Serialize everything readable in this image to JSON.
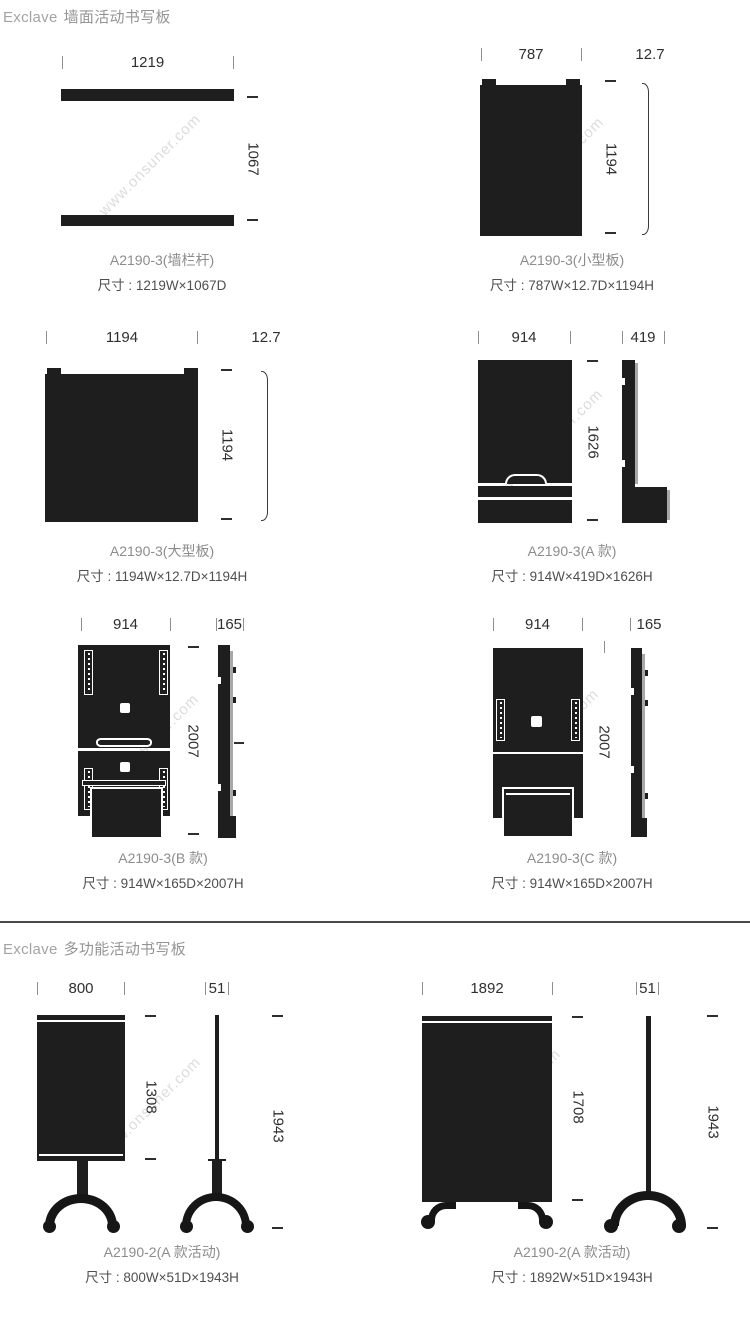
{
  "watermark": "www.onsuner.com",
  "colors": {
    "ink": "#1e1e1e",
    "dimension_text": "#2f2f2f",
    "caption_name": "#8c8c8c",
    "caption_size": "#4f4f4f",
    "header_text": "#949494",
    "divider": "#4a4a4a",
    "watermark": "#dcdcdc"
  },
  "sections": [
    {
      "brand": "Exclave",
      "title": "墙面活动书写板",
      "panels": [
        {
          "width": "1219",
          "height": "1067",
          "name": "A2190-3(墙栏杆)",
          "size": "尺寸 : 1219W×1067D"
        },
        {
          "width": "787",
          "depth": "12.7",
          "height": "1194",
          "name": "A2190-3(小型板)",
          "size": "尺寸 : 787W×12.7D×1194H"
        },
        {
          "width": "1194",
          "depth": "12.7",
          "height": "1194",
          "name": "A2190-3(大型板)",
          "size": "尺寸 : 1194W×12.7D×1194H"
        },
        {
          "width": "914",
          "depth": "419",
          "height": "1626",
          "name": "A2190-3(A 款)",
          "size": "尺寸 : 914W×419D×1626H"
        },
        {
          "width": "914",
          "depth": "165",
          "height": "2007",
          "name": "A2190-3(B 款)",
          "size": "尺寸 : 914W×165D×2007H"
        },
        {
          "width": "914",
          "depth": "165",
          "height": "2007",
          "name": "A2190-3(C 款)",
          "size": "尺寸 : 914W×165D×2007H"
        }
      ]
    },
    {
      "brand": "Exclave",
      "title": "多功能活动书写板",
      "panels": [
        {
          "width": "800",
          "depth": "51",
          "board_height": "1308",
          "height": "1943",
          "name": "A2190-2(A 款活动)",
          "size": "尺寸 : 800W×51D×1943H"
        },
        {
          "width": "1892",
          "depth": "51",
          "board_height": "1708",
          "height": "1943",
          "name": "A2190-2(A 款活动)",
          "size": "尺寸 : 1892W×51D×1943H"
        }
      ]
    }
  ]
}
